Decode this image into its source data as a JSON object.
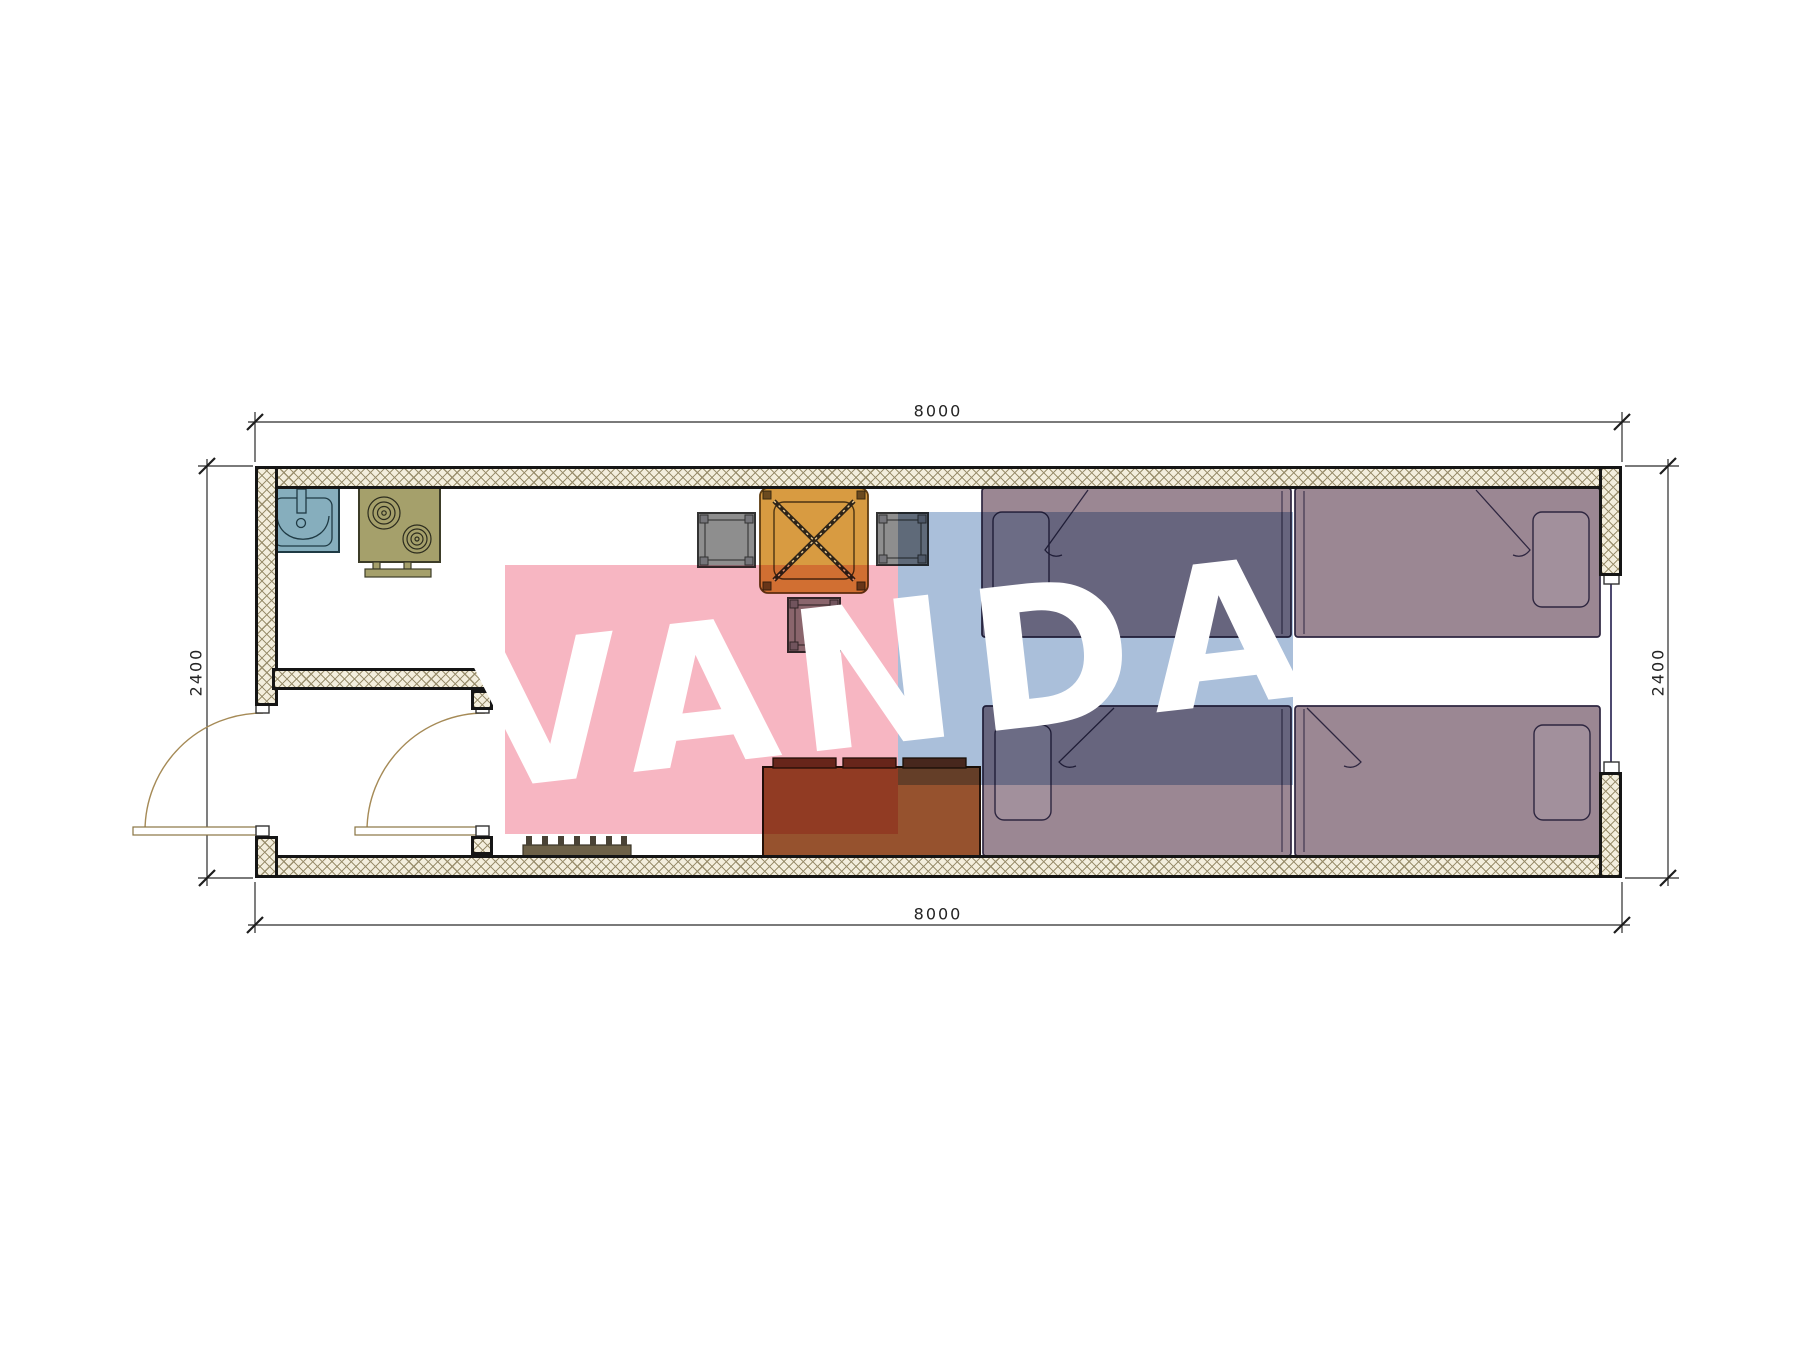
{
  "page": {
    "type": "architectural floor plan drawing",
    "background_color": "#ffffff"
  },
  "dimensions": {
    "top": "8000",
    "bottom": "8000",
    "left": "2400",
    "right": "2400"
  },
  "watermark": {
    "text": "VANDA",
    "text_color": "#ffffff",
    "pink_color": "#f7b6c2",
    "blue_color": "#aabfda"
  },
  "palette": {
    "wall_hatch_bg": "#f3eedd",
    "wall_hatch_line": "#968b69",
    "wall_edge": "#151515",
    "dim_line": "#2a2a2a",
    "door_arc": "#a58a56",
    "sink": "#86aebd",
    "stove": "#a5a06b",
    "table": "#d89b41",
    "stool": "#8e8e8e",
    "sofa_body": "#96522e",
    "sofa_back": "#6a3322",
    "bed": "#9b8793",
    "pillow": "#a2909c",
    "radiator": "#6d6148"
  },
  "furniture": [
    "sink",
    "stove",
    "dining-table",
    "stool-left",
    "stool-right",
    "stool-bottom",
    "sofa",
    "bed-top-left",
    "bed-top-right",
    "bed-bottom-left",
    "bed-bottom-right",
    "shoe-rack",
    "entry-door",
    "vestibule-door",
    "window-right-wall"
  ]
}
